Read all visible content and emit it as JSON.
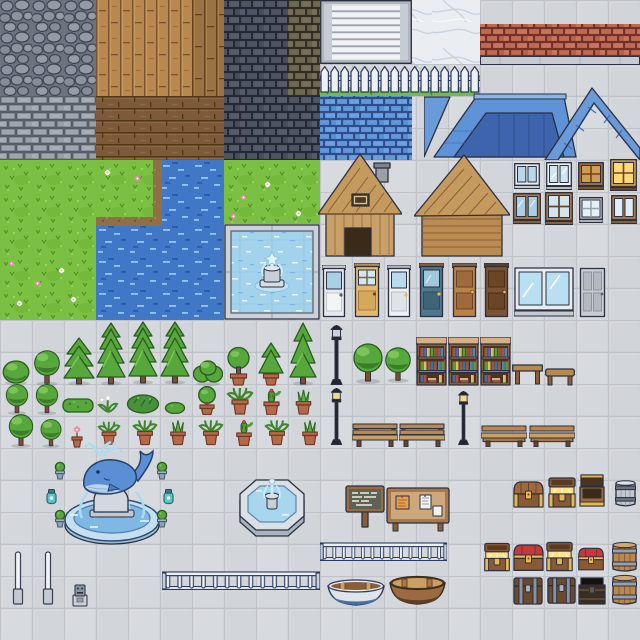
{
  "meta": {
    "title": "Pixel Town Tileset Sprite Sheet",
    "width": 640,
    "height": 640,
    "tile_size": 32
  },
  "palette": {
    "plaza_tile": "#d4d7db",
    "grout": "#bfc3c9",
    "cobblestone": "#8b93a0",
    "stone_brick": "#9fa6ae",
    "dark_brick": "#4e5463",
    "olive_brick": "#6e6853",
    "red_brick": "#c06a52",
    "blue_brick": "#6397dc",
    "wood_light": "#b8884f",
    "wood_dark": "#7d5a38",
    "marble": "#eaedf1",
    "grass": "#7cc043",
    "water": "#4177c7",
    "pool_water": "#a3d2ec",
    "roof_blue": "#5f93d8",
    "roof_blue_dark": "#3d64ad",
    "tree_green": "#56a73c",
    "terracotta_pot": "#b5694a",
    "chest_wood": "#8a5a34",
    "chest_gold": "#e8b84a",
    "chest_red": "#c23a3a",
    "outline": "#2b3040"
  },
  "terrain": [
    {
      "name": "plaza-floor",
      "type": "plaza",
      "x": 0,
      "y": 0,
      "w": 640,
      "h": 640
    },
    {
      "name": "cobblestone-tiles",
      "type": "cobble",
      "x": 0,
      "y": 0,
      "w": 96,
      "h": 96
    },
    {
      "name": "stone-brick-wall",
      "type": "stonebrick",
      "x": 0,
      "y": 96,
      "w": 96,
      "h": 64
    },
    {
      "name": "wood-plank-floor",
      "type": "wood-v",
      "x": 96,
      "y": 0,
      "w": 96,
      "h": 96
    },
    {
      "name": "wood-plank-floor-dark",
      "type": "wood-v-dark",
      "x": 192,
      "y": 0,
      "w": 32,
      "h": 96
    },
    {
      "name": "wood-plank-floor-horizontal",
      "type": "wood-h",
      "x": 96,
      "y": 96,
      "w": 128,
      "h": 64
    },
    {
      "name": "dark-brick-wall",
      "type": "brick-dark",
      "x": 224,
      "y": 0,
      "w": 64,
      "h": 160
    },
    {
      "name": "olive-brick-wall",
      "type": "brick-olive",
      "x": 288,
      "y": 0,
      "w": 32,
      "h": 96
    },
    {
      "name": "dark-brick-wall",
      "type": "brick-dark",
      "x": 288,
      "y": 96,
      "w": 32,
      "h": 64
    },
    {
      "name": "marble-tiles",
      "type": "marble",
      "x": 412,
      "y": 0,
      "w": 68,
      "h": 64
    },
    {
      "name": "red-brick-band",
      "type": "brick-red",
      "x": 480,
      "y": 24,
      "w": 160,
      "h": 32
    },
    {
      "name": "blue-brick-wall",
      "type": "brick-blue",
      "x": 320,
      "y": 96,
      "w": 92,
      "h": 64
    },
    {
      "name": "grass-field",
      "type": "grass",
      "x": 0,
      "y": 160,
      "w": 160,
      "h": 64
    },
    {
      "name": "grass-field",
      "type": "grass",
      "x": 0,
      "y": 224,
      "w": 96,
      "h": 96
    },
    {
      "name": "grass-field",
      "type": "grass",
      "x": 224,
      "y": 160,
      "w": 96,
      "h": 64
    },
    {
      "name": "water-tiles",
      "type": "water",
      "x": 160,
      "y": 160,
      "w": 64,
      "h": 64
    },
    {
      "name": "water-tiles",
      "type": "water",
      "x": 96,
      "y": 224,
      "w": 128,
      "h": 96
    },
    {
      "name": "sand-shore",
      "type": "sand",
      "x": 96,
      "y": 217,
      "w": 66,
      "h": 9
    },
    {
      "name": "sand-shore",
      "type": "sand",
      "x": 153,
      "y": 160,
      "w": 9,
      "h": 60
    }
  ],
  "objects": [
    {
      "name": "window-blinds",
      "type": "blinds",
      "x": 320,
      "y": 0,
      "w": 92,
      "h": 64
    },
    {
      "name": "brick-ledge",
      "type": "ledge",
      "x": 480,
      "y": 56,
      "w": 160,
      "h": 9
    },
    {
      "name": "picket-fence",
      "type": "fence",
      "x": 320,
      "y": 64,
      "w": 160,
      "h": 32
    },
    {
      "name": "blue-roof-set",
      "type": "roofs",
      "x": 424,
      "y": 83,
      "w": 216,
      "h": 77
    },
    {
      "name": "wood-cabin-chimney",
      "type": "house-a",
      "x": 318,
      "y": 152,
      "w": 84,
      "h": 108
    },
    {
      "name": "wood-cabin-plain",
      "type": "house-b",
      "x": 414,
      "y": 152,
      "w": 96,
      "h": 108
    },
    {
      "name": "white-window",
      "type": "window-white",
      "x": 514,
      "y": 163,
      "w": 26,
      "h": 26
    },
    {
      "name": "trim-window",
      "type": "window-trim",
      "x": 546,
      "y": 162,
      "w": 26,
      "h": 28
    },
    {
      "name": "amber-window",
      "type": "window-amber",
      "x": 578,
      "y": 162,
      "w": 26,
      "h": 28
    },
    {
      "name": "lit-window",
      "type": "window-lit",
      "x": 610,
      "y": 159,
      "w": 27,
      "h": 32
    },
    {
      "name": "tall-wood-window",
      "type": "window-wood-tall",
      "x": 513,
      "y": 193,
      "w": 28,
      "h": 31
    },
    {
      "name": "grid-wood-window",
      "type": "window-wood-grid",
      "x": 545,
      "y": 192,
      "w": 28,
      "h": 33
    },
    {
      "name": "small-window",
      "type": "window-small",
      "x": 579,
      "y": 197,
      "w": 24,
      "h": 26
    },
    {
      "name": "pale-window",
      "type": "window-pale",
      "x": 611,
      "y": 195,
      "w": 26,
      "h": 29
    },
    {
      "name": "white-glass-door",
      "type": "door-white",
      "x": 322,
      "y": 265,
      "w": 24,
      "h": 53
    },
    {
      "name": "tan-pane-door",
      "type": "door-tan",
      "x": 354,
      "y": 263,
      "w": 26,
      "h": 55
    },
    {
      "name": "white-blue-door",
      "type": "door-white2",
      "x": 387,
      "y": 265,
      "w": 24,
      "h": 53
    },
    {
      "name": "teal-glass-door",
      "type": "door-teal",
      "x": 419,
      "y": 263,
      "w": 25,
      "h": 55
    },
    {
      "name": "light-wood-door",
      "type": "door-wood",
      "x": 452,
      "y": 263,
      "w": 25,
      "h": 55
    },
    {
      "name": "dark-wood-door",
      "type": "door-wood-dark",
      "x": 484,
      "y": 263,
      "w": 25,
      "h": 55
    },
    {
      "name": "large-shop-window",
      "type": "window-large",
      "x": 514,
      "y": 267,
      "w": 60,
      "h": 50
    },
    {
      "name": "grey-panel-door",
      "type": "door-grey",
      "x": 579,
      "y": 267,
      "w": 27,
      "h": 51
    },
    {
      "name": "round-bush",
      "type": "bush-round",
      "x": 2,
      "y": 359,
      "w": 28,
      "h": 26
    },
    {
      "name": "round-tree",
      "type": "tree-round",
      "x": 31,
      "y": 349,
      "w": 32,
      "h": 37
    },
    {
      "name": "conifer-tree",
      "type": "conifer",
      "x": 63,
      "y": 336,
      "w": 32,
      "h": 50
    },
    {
      "name": "tall-conifer",
      "type": "conifer-tall",
      "x": 96,
      "y": 321,
      "w": 30,
      "h": 65
    },
    {
      "name": "tall-conifer",
      "type": "conifer-tall",
      "x": 128,
      "y": 319,
      "w": 30,
      "h": 67
    },
    {
      "name": "tall-conifer",
      "type": "conifer-tall",
      "x": 160,
      "y": 319,
      "w": 30,
      "h": 67
    },
    {
      "name": "wide-bush",
      "type": "bush-wide",
      "x": 193,
      "y": 357,
      "w": 30,
      "h": 29
    },
    {
      "name": "potted-round-tree",
      "type": "potted-tree",
      "x": 225,
      "y": 347,
      "w": 27,
      "h": 39
    },
    {
      "name": "potted-conifer",
      "type": "potted-conifer",
      "x": 257,
      "y": 341,
      "w": 28,
      "h": 45
    },
    {
      "name": "double-conifer",
      "type": "conifer-duo",
      "x": 289,
      "y": 321,
      "w": 28,
      "h": 65
    },
    {
      "name": "round-tree",
      "type": "tree-round",
      "x": 352,
      "y": 342,
      "w": 32,
      "h": 42
    },
    {
      "name": "round-tree",
      "type": "tree-round",
      "x": 384,
      "y": 345,
      "w": 28,
      "h": 39
    },
    {
      "name": "street-lamp",
      "type": "lamp",
      "x": 328,
      "y": 325,
      "w": 17,
      "h": 60
    },
    {
      "name": "bookshelf",
      "type": "bookshelf",
      "x": 416,
      "y": 337,
      "w": 31,
      "h": 49
    },
    {
      "name": "bookshelf",
      "type": "bookshelf",
      "x": 448,
      "y": 337,
      "w": 31,
      "h": 49
    },
    {
      "name": "bookshelf",
      "type": "bookshelf",
      "x": 480,
      "y": 337,
      "w": 31,
      "h": 49
    },
    {
      "name": "wood-table",
      "type": "table",
      "x": 512,
      "y": 363,
      "w": 31,
      "h": 23
    },
    {
      "name": "low-bench",
      "type": "bench-side",
      "x": 545,
      "y": 367,
      "w": 30,
      "h": 19
    },
    {
      "name": "round-tree",
      "type": "tree-round",
      "x": 2,
      "y": 383,
      "w": 30,
      "h": 32
    },
    {
      "name": "round-tree",
      "type": "tree-round",
      "x": 32,
      "y": 383,
      "w": 30,
      "h": 32
    },
    {
      "name": "hedge",
      "type": "hedge",
      "x": 62,
      "y": 396,
      "w": 32,
      "h": 18
    },
    {
      "name": "flower-sprout",
      "type": "sprout",
      "x": 96,
      "y": 394,
      "w": 24,
      "h": 20
    },
    {
      "name": "leafy-bush",
      "type": "bush-leafy",
      "x": 126,
      "y": 391,
      "w": 34,
      "h": 23
    },
    {
      "name": "tiny-bush",
      "type": "bush-tiny",
      "x": 164,
      "y": 400,
      "w": 22,
      "h": 14
    },
    {
      "name": "potted-ball-tree",
      "type": "potted-ball",
      "x": 194,
      "y": 386,
      "w": 26,
      "h": 29
    },
    {
      "name": "potted-fern",
      "type": "pot-leafy",
      "x": 226,
      "y": 387,
      "w": 28,
      "h": 28
    },
    {
      "name": "potted-cactus",
      "type": "pot-cactus",
      "x": 258,
      "y": 388,
      "w": 27,
      "h": 27
    },
    {
      "name": "potted-snake-plant",
      "type": "pot-spiky",
      "x": 290,
      "y": 389,
      "w": 27,
      "h": 26
    },
    {
      "name": "street-lamp-warm",
      "type": "lamp-warm",
      "x": 328,
      "y": 388,
      "w": 17,
      "h": 57
    },
    {
      "name": "street-lamp-warm",
      "type": "lamp-warm",
      "x": 455,
      "y": 391,
      "w": 17,
      "h": 54
    },
    {
      "name": "round-tree",
      "type": "tree-round",
      "x": 6,
      "y": 413,
      "w": 30,
      "h": 35
    },
    {
      "name": "ball-tree",
      "type": "tree-round",
      "x": 38,
      "y": 418,
      "w": 26,
      "h": 30
    },
    {
      "name": "potted-pink-flower",
      "type": "pot-flower",
      "x": 68,
      "y": 426,
      "w": 18,
      "h": 22
    },
    {
      "name": "potted-plant",
      "type": "pot-leafy",
      "x": 97,
      "y": 420,
      "w": 24,
      "h": 26
    },
    {
      "name": "potted-plant",
      "type": "pot-leafy",
      "x": 132,
      "y": 419,
      "w": 26,
      "h": 27
    },
    {
      "name": "potted-snake-plant",
      "type": "pot-spiky",
      "x": 165,
      "y": 419,
      "w": 26,
      "h": 27
    },
    {
      "name": "potted-plant",
      "type": "pot-leafy",
      "x": 198,
      "y": 419,
      "w": 26,
      "h": 27
    },
    {
      "name": "potted-cactus",
      "type": "pot-cactus",
      "x": 231,
      "y": 419,
      "w": 26,
      "h": 27
    },
    {
      "name": "potted-plant",
      "type": "pot-leafy",
      "x": 264,
      "y": 419,
      "w": 26,
      "h": 27
    },
    {
      "name": "potted-snake-plant",
      "type": "pot-spiky",
      "x": 297,
      "y": 419,
      "w": 26,
      "h": 27
    },
    {
      "name": "park-bench",
      "type": "bench",
      "x": 352,
      "y": 423,
      "w": 46,
      "h": 24
    },
    {
      "name": "park-bench",
      "type": "bench",
      "x": 399,
      "y": 423,
      "w": 46,
      "h": 24
    },
    {
      "name": "park-bench-low",
      "type": "bench2",
      "x": 481,
      "y": 425,
      "w": 46,
      "h": 22
    },
    {
      "name": "park-bench-low",
      "type": "bench2",
      "x": 529,
      "y": 425,
      "w": 46,
      "h": 22
    },
    {
      "name": "tiled-pool-fountain",
      "type": "pool",
      "x": 224,
      "y": 224,
      "w": 96,
      "h": 96
    },
    {
      "name": "whale-fountain",
      "type": "fountain-whale",
      "x": 60,
      "y": 440,
      "w": 104,
      "h": 106
    },
    {
      "name": "small-potted-plant",
      "type": "pot-sm",
      "x": 52,
      "y": 461,
      "w": 16,
      "h": 19
    },
    {
      "name": "small-potted-plant",
      "type": "pot-sm",
      "x": 154,
      "y": 461,
      "w": 16,
      "h": 19
    },
    {
      "name": "small-potted-plant",
      "type": "pot-sm",
      "x": 52,
      "y": 509,
      "w": 16,
      "h": 19
    },
    {
      "name": "small-potted-plant",
      "type": "pot-sm",
      "x": 154,
      "y": 509,
      "w": 16,
      "h": 19
    },
    {
      "name": "teal-lantern",
      "type": "lantern",
      "x": 45,
      "y": 488,
      "w": 13,
      "h": 18
    },
    {
      "name": "teal-lantern",
      "type": "lantern",
      "x": 162,
      "y": 488,
      "w": 13,
      "h": 18
    },
    {
      "name": "octagon-fountain",
      "type": "fountain-oct",
      "x": 236,
      "y": 476,
      "w": 72,
      "h": 66
    },
    {
      "name": "wooden-sign",
      "type": "signpost",
      "x": 344,
      "y": 482,
      "w": 42,
      "h": 48
    },
    {
      "name": "notice-board",
      "type": "noticeboard",
      "x": 386,
      "y": 486,
      "w": 64,
      "h": 46
    },
    {
      "name": "railing",
      "type": "railing",
      "x": 320,
      "y": 542,
      "w": 127,
      "h": 21
    },
    {
      "name": "railing",
      "type": "railing",
      "x": 162,
      "y": 571,
      "w": 158,
      "h": 21
    },
    {
      "name": "bollard-post",
      "type": "bollard",
      "x": 12,
      "y": 551,
      "w": 12,
      "h": 54
    },
    {
      "name": "bollard-post",
      "type": "bollard",
      "x": 42,
      "y": 551,
      "w": 12,
      "h": 54
    },
    {
      "name": "parking-meter",
      "type": "meter",
      "x": 71,
      "y": 584,
      "w": 18,
      "h": 23
    },
    {
      "name": "blue-rowboat",
      "type": "boat-blue",
      "x": 327,
      "y": 577,
      "w": 58,
      "h": 31
    },
    {
      "name": "wood-rowboat",
      "type": "boat-brown",
      "x": 389,
      "y": 572,
      "w": 57,
      "h": 36
    },
    {
      "name": "treasure-chest-closed",
      "type": "chest-closed",
      "x": 512,
      "y": 478,
      "w": 33,
      "h": 31
    },
    {
      "name": "treasure-chest-open",
      "type": "chest-open",
      "x": 546,
      "y": 477,
      "w": 32,
      "h": 32
    },
    {
      "name": "treasure-chest-open-empty",
      "type": "chest-open-tall",
      "x": 577,
      "y": 474,
      "w": 30,
      "h": 35
    },
    {
      "name": "small-grey-barrel",
      "type": "barrel-grey",
      "x": 613,
      "y": 479,
      "w": 25,
      "h": 29
    },
    {
      "name": "treasure-chest-open",
      "type": "chest-open",
      "x": 482,
      "y": 542,
      "w": 30,
      "h": 31
    },
    {
      "name": "red-treasure-chest",
      "type": "chest-red",
      "x": 512,
      "y": 541,
      "w": 33,
      "h": 32
    },
    {
      "name": "treasure-chest-open",
      "type": "chest-open",
      "x": 544,
      "y": 541,
      "w": 31,
      "h": 32
    },
    {
      "name": "red-treasure-chest",
      "type": "chest-red",
      "x": 577,
      "y": 544,
      "w": 28,
      "h": 29
    },
    {
      "name": "wood-barrel",
      "type": "barrel",
      "x": 610,
      "y": 541,
      "w": 29,
      "h": 32
    },
    {
      "name": "dark-strapped-chest",
      "type": "chest-dark",
      "x": 512,
      "y": 575,
      "w": 32,
      "h": 31
    },
    {
      "name": "dark-strapped-chest",
      "type": "chest-dark",
      "x": 546,
      "y": 574,
      "w": 31,
      "h": 32
    },
    {
      "name": "black-chest",
      "type": "chest-black",
      "x": 577,
      "y": 576,
      "w": 30,
      "h": 30
    },
    {
      "name": "wood-barrel",
      "type": "barrel",
      "x": 610,
      "y": 574,
      "w": 29,
      "h": 32
    },
    {
      "name": "white-flower",
      "type": "flower-white",
      "x": 104,
      "y": 169,
      "w": 7,
      "h": 7
    },
    {
      "name": "pink-flower",
      "type": "flower-pink",
      "x": 134,
      "y": 175,
      "w": 7,
      "h": 7
    },
    {
      "name": "white-flower",
      "type": "flower-white",
      "x": 264,
      "y": 181,
      "w": 7,
      "h": 7
    },
    {
      "name": "pink-flower",
      "type": "flower-pink",
      "x": 240,
      "y": 194,
      "w": 7,
      "h": 7
    },
    {
      "name": "white-flower",
      "type": "flower-white",
      "x": 295,
      "y": 210,
      "w": 7,
      "h": 7
    },
    {
      "name": "pink-flower",
      "type": "flower-pink",
      "x": 230,
      "y": 213,
      "w": 7,
      "h": 7
    },
    {
      "name": "pink-flower",
      "type": "flower-pink",
      "x": 8,
      "y": 260,
      "w": 7,
      "h": 7
    },
    {
      "name": "white-flower",
      "type": "flower-white",
      "x": 58,
      "y": 267,
      "w": 7,
      "h": 7
    },
    {
      "name": "pink-flower",
      "type": "flower-pink",
      "x": 34,
      "y": 280,
      "w": 7,
      "h": 7
    },
    {
      "name": "white-flower",
      "type": "flower-white",
      "x": 16,
      "y": 300,
      "w": 7,
      "h": 7
    },
    {
      "name": "white-flower",
      "type": "flower-white",
      "x": 70,
      "y": 296,
      "w": 7,
      "h": 7
    }
  ]
}
